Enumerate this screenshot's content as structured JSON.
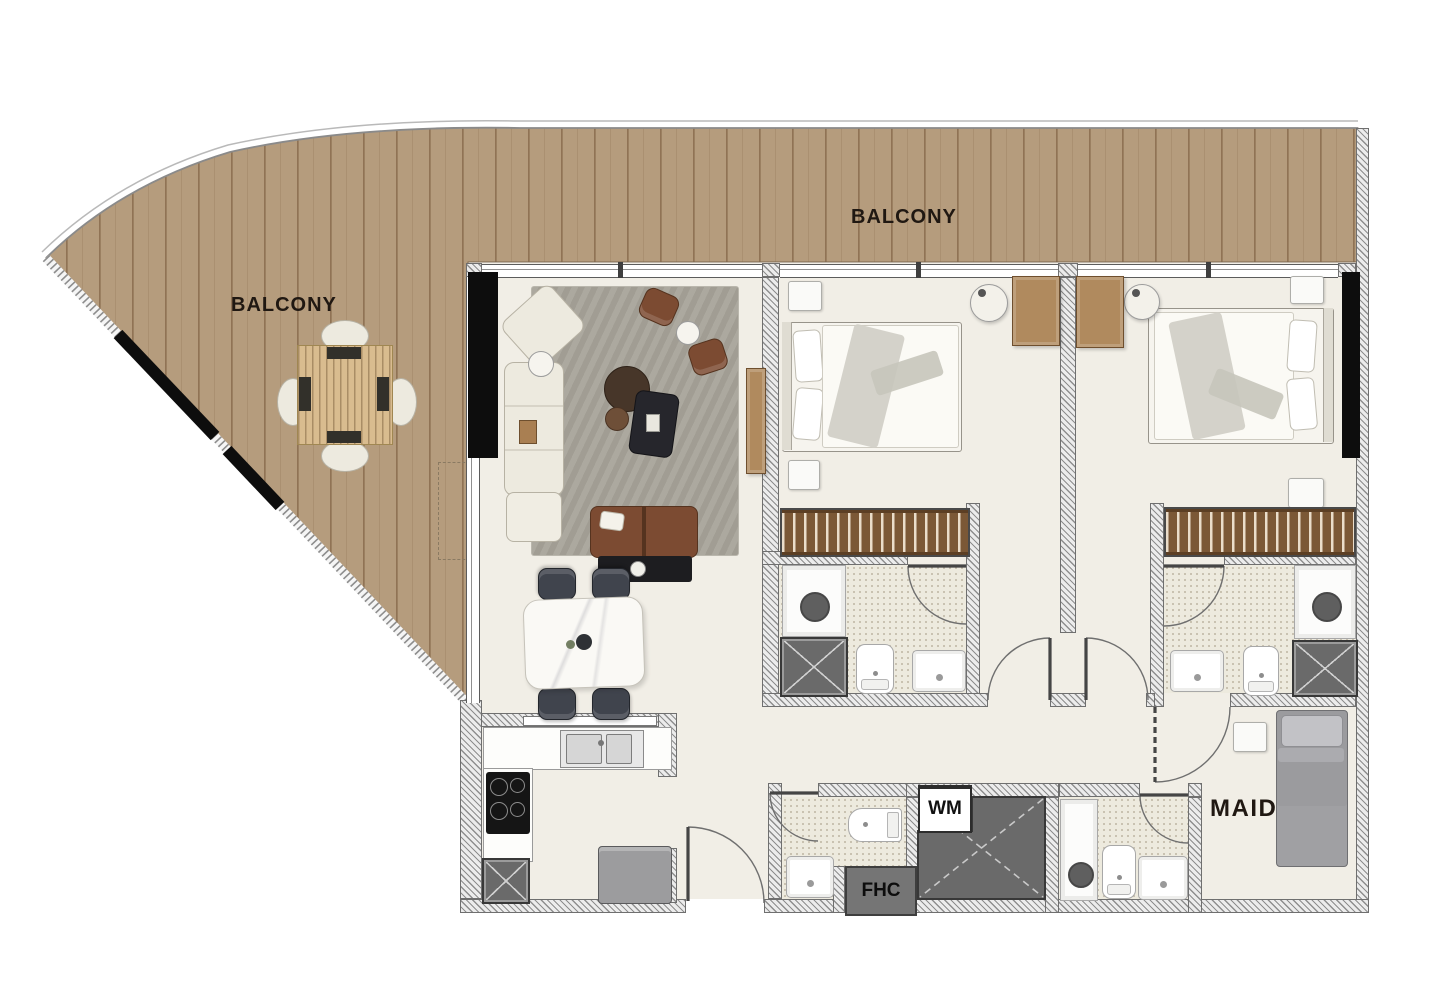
{
  "labels": {
    "balcony_left": "BALCONY",
    "balcony_top": "BALCONY",
    "maid": "MAID",
    "wm": "WM",
    "fhc": "FHC"
  },
  "colors": {
    "deck_wood": "#b59c7d",
    "deck_plank": "#8a6c4e",
    "deck_table": "#d9bc8f",
    "floor": "#f1eee6",
    "wall_fill": "#ececec",
    "wall_line": "#8e8e8e",
    "black": "#0d0d0d",
    "shaft": "#6a6a6a",
    "bath_floor": "#edeade",
    "rug": "#a8a49a",
    "sofa": "#edeadf",
    "brown_seat": "#7c4b32",
    "dark_table": "#43332a",
    "dining_chair": "#40444d",
    "wood_dresser": "#b08a5e",
    "wardrobe": "#7b5836",
    "maid_bed": "#9b9b9e",
    "marble": "#faf9f5"
  }
}
